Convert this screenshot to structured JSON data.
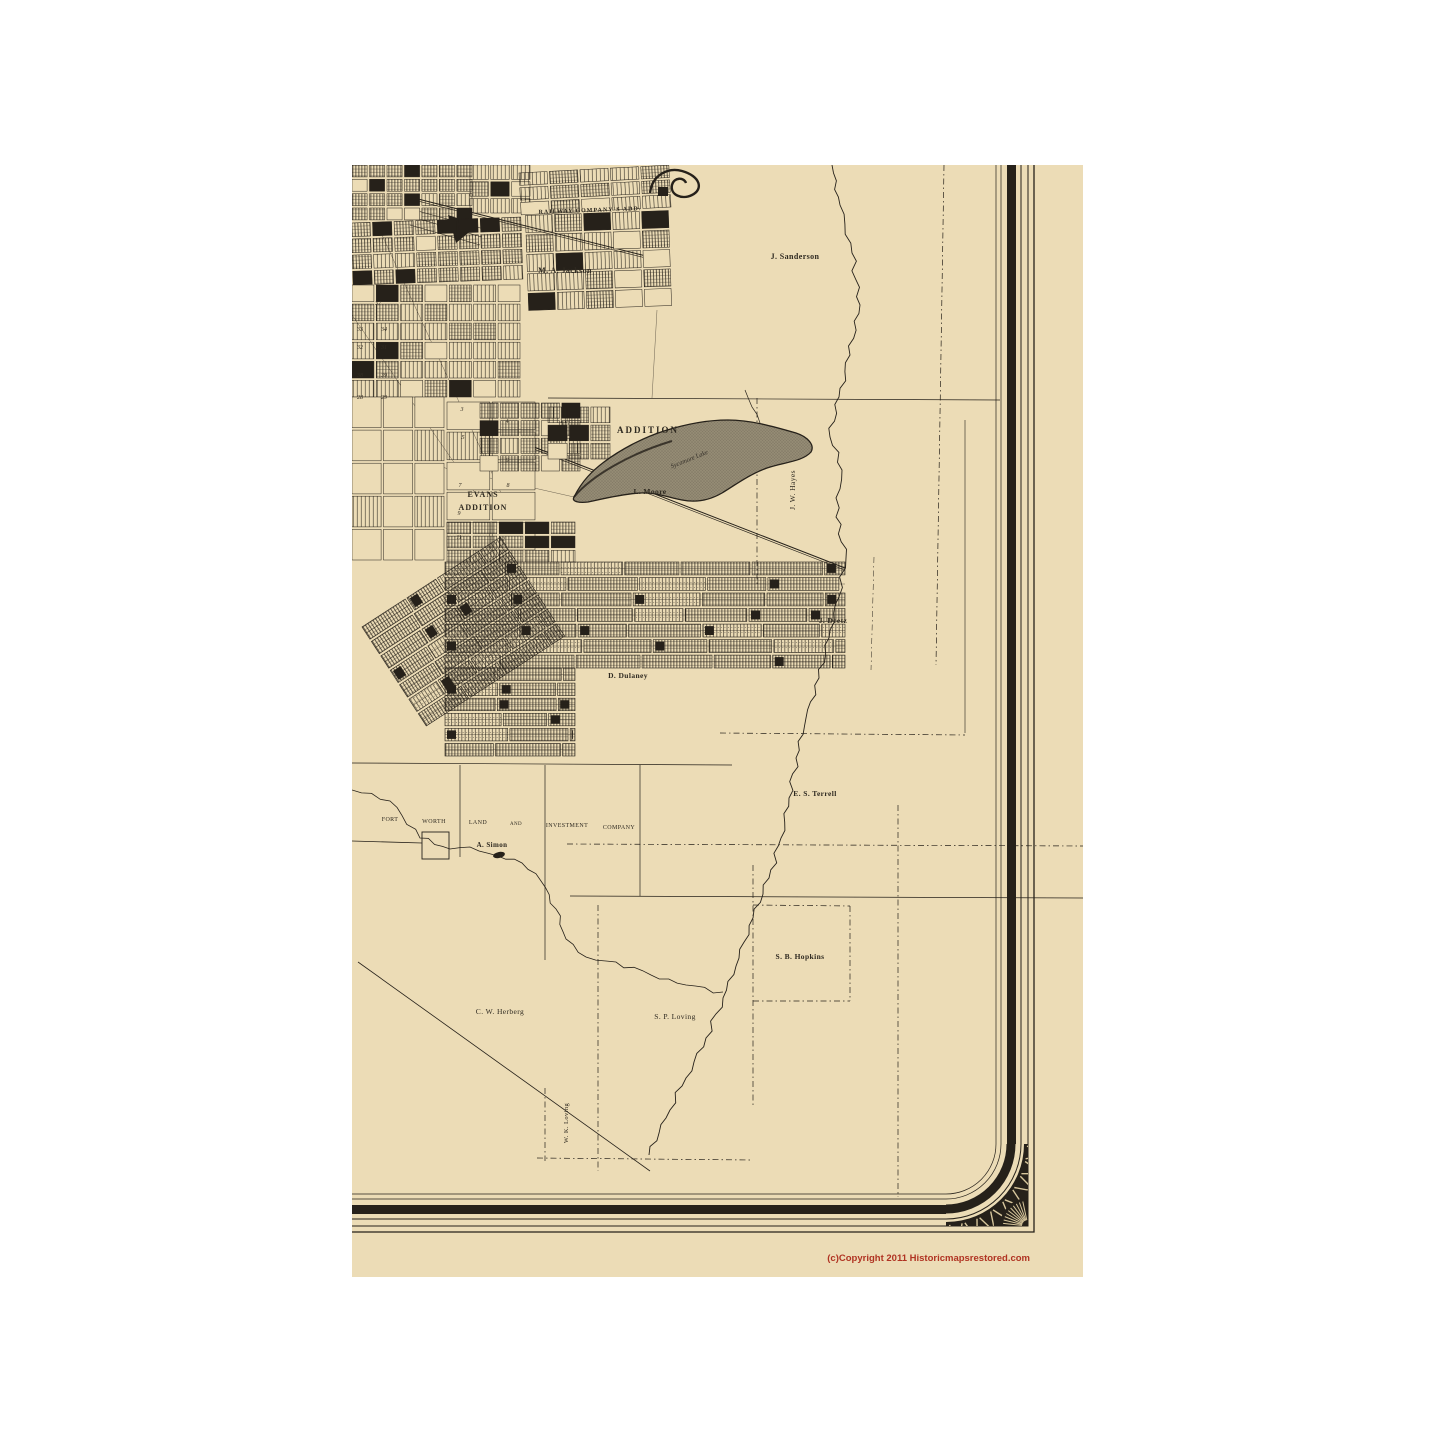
{
  "page": {
    "background": "#ffffff"
  },
  "sheet": {
    "paper_color": "#ecdcb6",
    "ink_color": "#26211a",
    "accent_red": "#b03322",
    "lake_color": "#948b74"
  },
  "map": {
    "kind": "historic-plat-map",
    "labels": [
      {
        "text": "M. A. Jackson",
        "x": 213,
        "y": 108,
        "size": 8,
        "bold": true
      },
      {
        "text": "J. Sanderson",
        "x": 443,
        "y": 94,
        "size": 8,
        "bold": true
      },
      {
        "text": "RAILWAY COMPANY'S ADD.",
        "x": 238,
        "y": 47,
        "size": 6,
        "bold": true,
        "rot": -2,
        "ls": 1
      },
      {
        "text": "ADDITION",
        "x": 296,
        "y": 268,
        "size": 9,
        "bold": true,
        "ls": 2
      },
      {
        "text": "EVANS",
        "x": 131,
        "y": 332,
        "size": 8,
        "bold": true,
        "ls": 1
      },
      {
        "text": "ADDITION",
        "x": 131,
        "y": 345,
        "size": 8,
        "bold": true,
        "ls": 1
      },
      {
        "text": "L. Moore",
        "x": 298,
        "y": 329,
        "size": 7.5,
        "bold": true
      },
      {
        "text": "J. W. Hayes",
        "x": 443,
        "y": 325,
        "size": 7.5,
        "rot": -90
      },
      {
        "text": "J. Deetz",
        "x": 481,
        "y": 458,
        "size": 7.5,
        "bold": true
      },
      {
        "text": "D. Dulaney",
        "x": 276,
        "y": 513,
        "size": 7.5,
        "bold": true
      },
      {
        "text": "E. S. Terrell",
        "x": 463,
        "y": 631,
        "size": 7.5,
        "bold": true
      },
      {
        "text": "FORT",
        "x": 38,
        "y": 656,
        "size": 6
      },
      {
        "text": "WORTH",
        "x": 82,
        "y": 658,
        "size": 6
      },
      {
        "text": "LAND",
        "x": 126,
        "y": 659,
        "size": 6
      },
      {
        "text": "AND",
        "x": 164,
        "y": 660,
        "size": 5
      },
      {
        "text": "INVESTMENT",
        "x": 215,
        "y": 662,
        "size": 6
      },
      {
        "text": "COMPANY",
        "x": 267,
        "y": 664,
        "size": 6
      },
      {
        "text": "A. Simon",
        "x": 140,
        "y": 682,
        "size": 7,
        "bold": true
      },
      {
        "text": "S. B. Hopkins",
        "x": 448,
        "y": 794,
        "size": 7.5,
        "bold": true
      },
      {
        "text": "C. W. Herberg",
        "x": 148,
        "y": 849,
        "size": 7.5
      },
      {
        "text": "S. P. Loving",
        "x": 323,
        "y": 854,
        "size": 7.5
      },
      {
        "text": "W. K. Loving",
        "x": 216,
        "y": 958,
        "size": 6.5,
        "rot": -90
      }
    ],
    "lake_label": {
      "text": "Sycamore Lake",
      "x": 338,
      "y": 296,
      "size": 6.5,
      "rot": -22
    },
    "lot_numbers": [
      {
        "t": "37",
        "x": 26,
        "y": 140
      },
      {
        "t": "33",
        "x": 8,
        "y": 166
      },
      {
        "t": "34",
        "x": 32,
        "y": 166
      },
      {
        "t": "32",
        "x": 8,
        "y": 184
      },
      {
        "t": "31",
        "x": 32,
        "y": 184
      },
      {
        "t": "38",
        "x": 8,
        "y": 212
      },
      {
        "t": "39",
        "x": 32,
        "y": 212
      },
      {
        "t": "28",
        "x": 8,
        "y": 234
      },
      {
        "t": "29",
        "x": 32,
        "y": 234
      },
      {
        "t": "3",
        "x": 110,
        "y": 246
      },
      {
        "t": "5",
        "x": 111,
        "y": 274
      },
      {
        "t": "7",
        "x": 108,
        "y": 322
      },
      {
        "t": "9",
        "x": 107,
        "y": 350
      },
      {
        "t": "11",
        "x": 107,
        "y": 374
      },
      {
        "t": "12",
        "x": 150,
        "y": 376
      },
      {
        "t": "4",
        "x": 155,
        "y": 258
      },
      {
        "t": "6",
        "x": 155,
        "y": 297
      },
      {
        "t": "8",
        "x": 156,
        "y": 322
      }
    ],
    "copyright": {
      "text": "(c)Copyright 2011 Historicmapsrestored.com"
    }
  }
}
